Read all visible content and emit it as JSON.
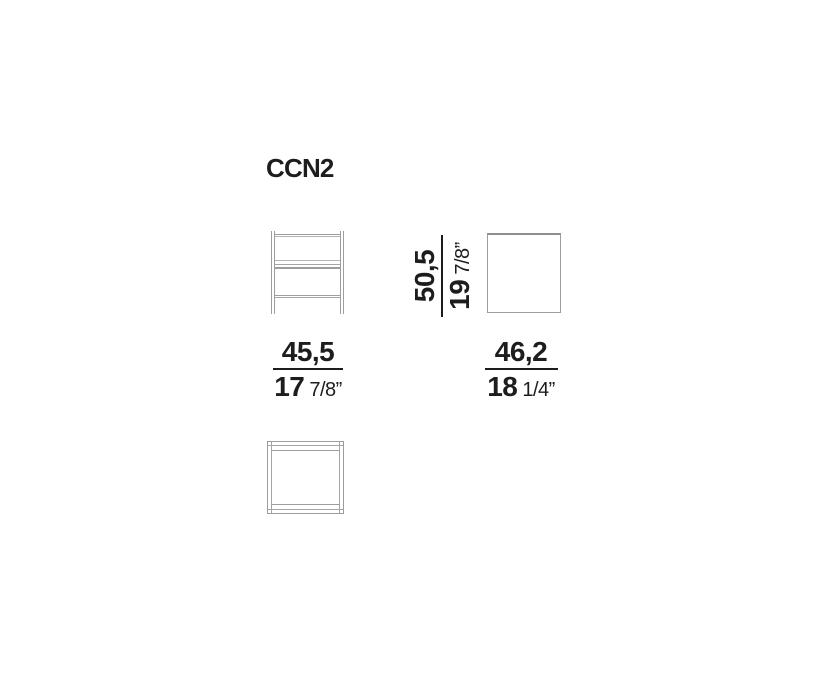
{
  "title": "CCN2",
  "colors": {
    "text": "#1d1d1b",
    "drawing_line": "#9d9d9c",
    "drawing_line_light": "#b4b4b3",
    "background": "#ffffff"
  },
  "dimensions": {
    "width": {
      "cm": "45,5",
      "inch_whole": "17",
      "inch_fraction": "7/8”"
    },
    "height": {
      "cm": "50,5",
      "inch_whole": "19",
      "inch_fraction": "7/8”"
    },
    "depth": {
      "cm": "46,2",
      "inch_whole": "18",
      "inch_fraction": "1/4”"
    }
  }
}
